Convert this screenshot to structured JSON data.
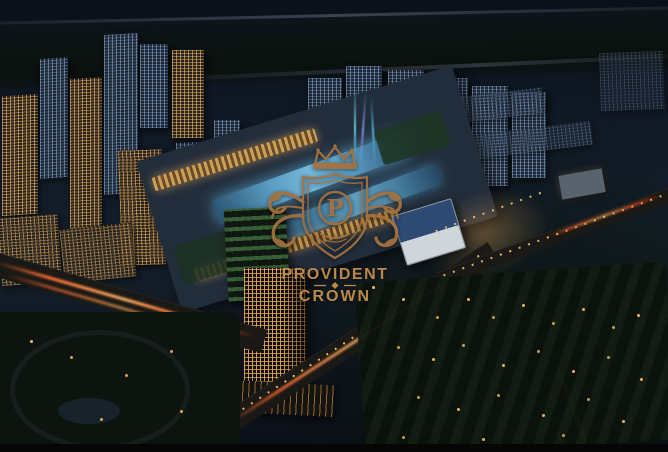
{
  "image": {
    "description": "Aerial night rendering of an illuminated mixed-use city development with skyscrapers, a glowing mall podium, landscaped roads and tree groves",
    "type": "architectural-render"
  },
  "watermark": {
    "monogram": "P",
    "name_line1": "PROVIDENT",
    "name_line2": "CROWN",
    "bronze": "#a4713f",
    "gold": "#c8924e",
    "icons": [
      "crown-icon",
      "shield-icon",
      "flourish-left-icon",
      "flourish-right-icon"
    ]
  },
  "palette": {
    "sky": "#0d1520",
    "warm_window": "#ffc87d",
    "cool_window": "#9db6dd",
    "pool_glow": "#66aacd",
    "road_trail": "#ff6a2e",
    "street_light": "#ffc468",
    "vegetation": "#0d150e",
    "bottom_bar": "#060606"
  }
}
